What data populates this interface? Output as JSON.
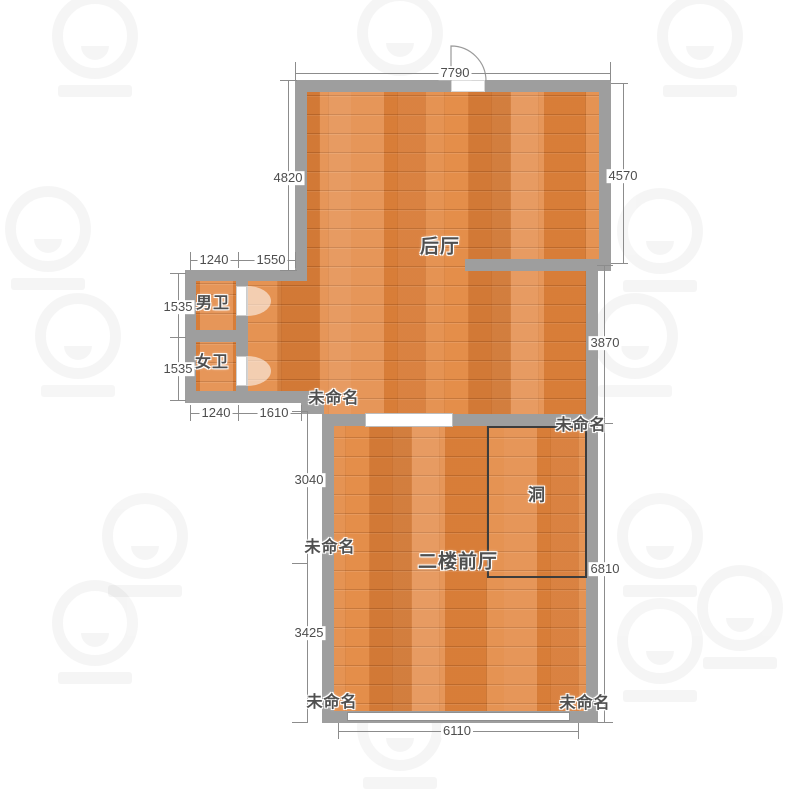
{
  "app": {
    "type": "floor-plan-view"
  },
  "colors": {
    "background": "#ffffff",
    "wall": "#9e9e9e",
    "floor": "#e2853e",
    "dim_line": "#8c8c8c",
    "dim_text": "#4d4d4d",
    "label_text": "#4f4f4f",
    "hole_stroke": "#3c3c3c",
    "door_arc": "rgba(255,255,255,0.55)"
  },
  "room_labels": [
    {
      "text": "后厅",
      "x": 440,
      "y": 245,
      "size": 19
    },
    {
      "text": "男卫",
      "x": 213,
      "y": 301,
      "size": 16
    },
    {
      "text": "女卫",
      "x": 212,
      "y": 360,
      "size": 16
    },
    {
      "text": "未命名",
      "x": 334,
      "y": 396,
      "size": 16
    },
    {
      "text": "未命名",
      "x": 581,
      "y": 423,
      "size": 16
    },
    {
      "text": "洞",
      "x": 537,
      "y": 493,
      "size": 17
    },
    {
      "text": "未命名",
      "x": 330,
      "y": 545,
      "size": 16
    },
    {
      "text": "二楼前厅",
      "x": 458,
      "y": 560,
      "size": 19
    },
    {
      "text": "未命名",
      "x": 332,
      "y": 700,
      "size": 16
    },
    {
      "text": "未命名",
      "x": 585,
      "y": 701,
      "size": 16
    }
  ],
  "dimensions": [
    {
      "text": "7790",
      "x": 455,
      "y": 73
    },
    {
      "text": "4820",
      "x": 288,
      "y": 178
    },
    {
      "text": "4570",
      "x": 623,
      "y": 176
    },
    {
      "text": "1240",
      "x": 214,
      "y": 260
    },
    {
      "text": "1550",
      "x": 271,
      "y": 260
    },
    {
      "text": "1535",
      "x": 178,
      "y": 307
    },
    {
      "text": "1535",
      "x": 178,
      "y": 369
    },
    {
      "text": "1240",
      "x": 216,
      "y": 413
    },
    {
      "text": "1610",
      "x": 274,
      "y": 413
    },
    {
      "text": "3870",
      "x": 605,
      "y": 343
    },
    {
      "text": "3040",
      "x": 309,
      "y": 480
    },
    {
      "text": "6810",
      "x": 605,
      "y": 569
    },
    {
      "text": "3425",
      "x": 309,
      "y": 633
    },
    {
      "text": "6110",
      "x": 457,
      "y": 731
    }
  ],
  "watermark_positions": [
    [
      95,
      45
    ],
    [
      400,
      42
    ],
    [
      700,
      45
    ],
    [
      48,
      238
    ],
    [
      660,
      240
    ],
    [
      78,
      345
    ],
    [
      635,
      345
    ],
    [
      145,
      545
    ],
    [
      660,
      545
    ],
    [
      95,
      632
    ],
    [
      740,
      617
    ],
    [
      660,
      650
    ],
    [
      400,
      737
    ]
  ]
}
